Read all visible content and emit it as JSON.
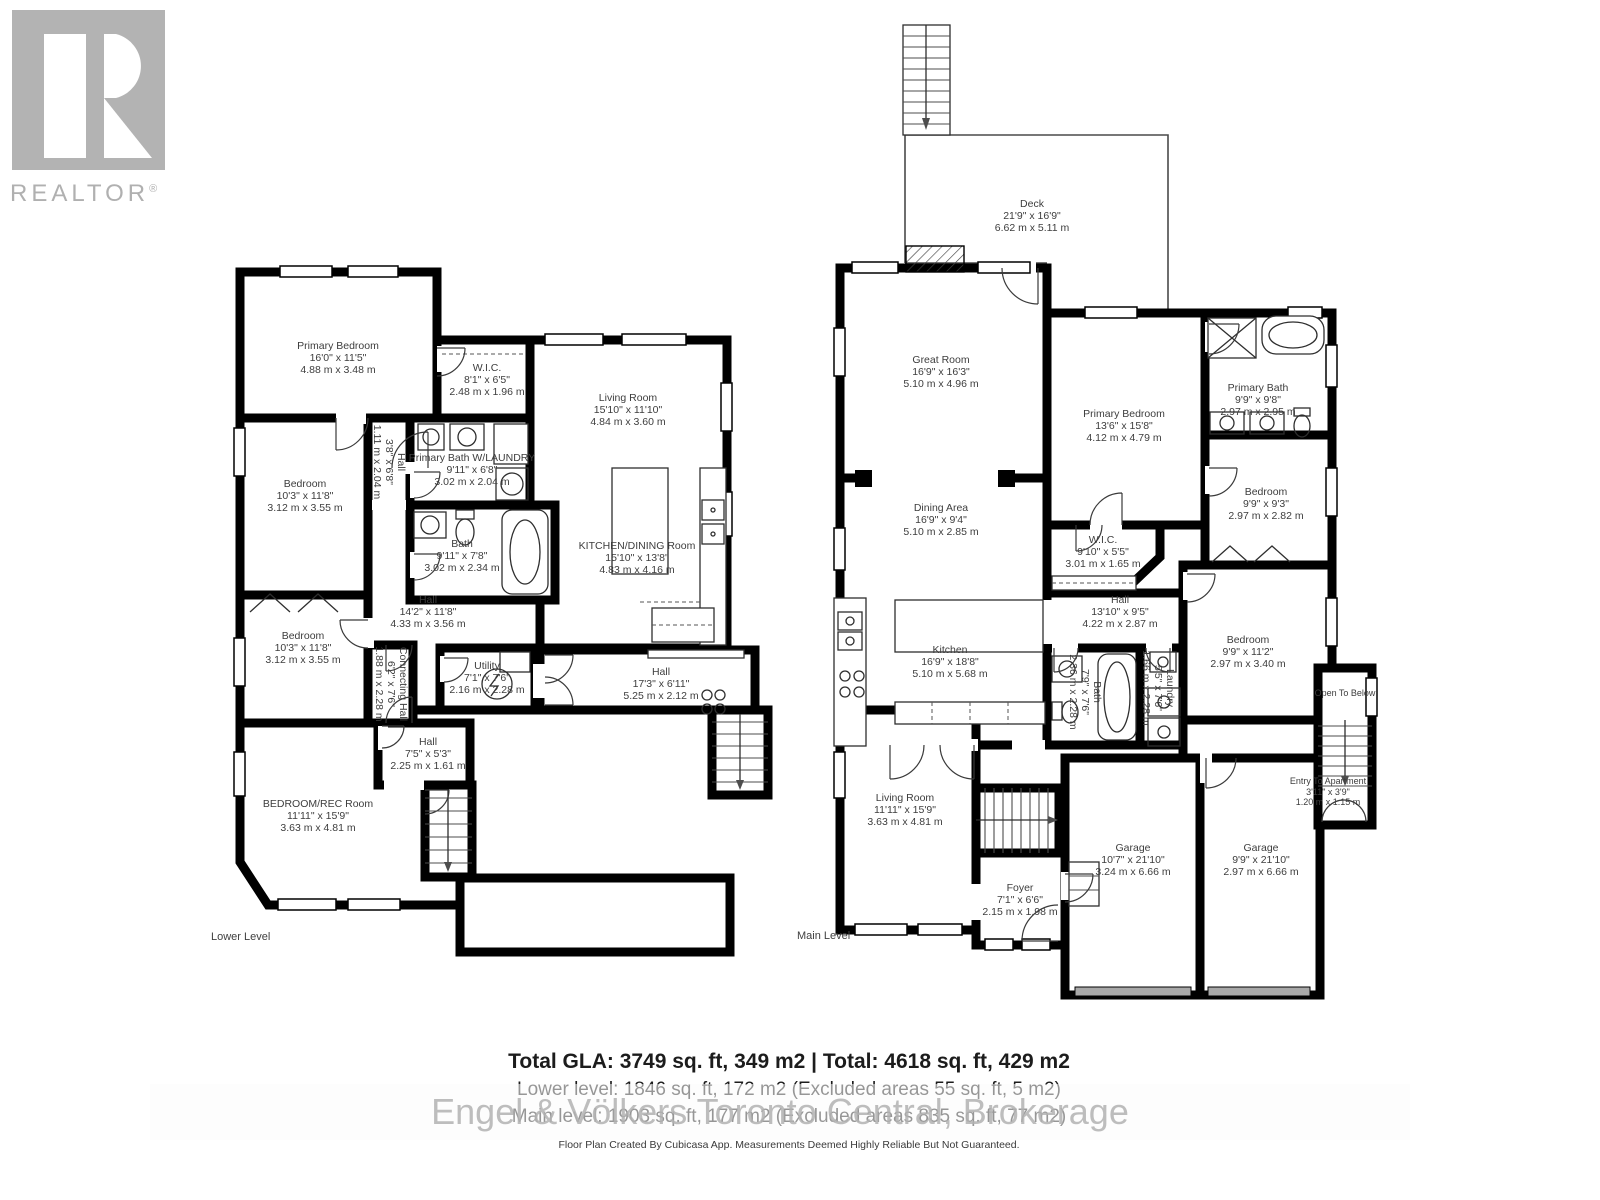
{
  "branding": {
    "realtor": "REALTOR",
    "reg": "®"
  },
  "colors": {
    "wall": "#000000",
    "label_text": "#3d3d3d",
    "logo_gray": "#b3b3b3",
    "watermark_gray": "#c9c9c9",
    "garage_door_gray": "#a8a8a8"
  },
  "floors": {
    "lower": {
      "caption": "Lower Level",
      "rooms": [
        {
          "name": "Primary Bedroom",
          "ft": "16'0\" x 11'5\"",
          "m": "4.88 m x 3.48 m"
        },
        {
          "name": "W.I.C.",
          "ft": "8'1\" x 6'5\"",
          "m": "2.48 m x 1.96 m"
        },
        {
          "name": "Living Room",
          "ft": "15'10\" x 11'10\"",
          "m": "4.84 m x 3.60 m"
        },
        {
          "name": "Bedroom",
          "ft": "10'3\" x 11'8\"",
          "m": "3.12 m x 3.55 m"
        },
        {
          "name": "Hall",
          "ft": "3'8\" x 6'8\"",
          "m": "1.11 m x 2.04 m"
        },
        {
          "name": "Primary Bath W/LAUNDRY",
          "ft": "9'11\" x 6'8\"",
          "m": "3.02 m x 2.04 m"
        },
        {
          "name": "Bath",
          "ft": "9'11\" x 7'8\"",
          "m": "3.02 m x 2.34 m"
        },
        {
          "name": "KITCHEN/DINING Room",
          "ft": "15'10\" x 13'8\"",
          "m": "4.83 m x 4.16 m"
        },
        {
          "name": "Hall",
          "ft": "14'2\" x 11'8\"",
          "m": "4.33 m x 3.56 m"
        },
        {
          "name": "Bedroom",
          "ft": "10'3\" x 11'8\"",
          "m": "3.12 m x 3.55 m"
        },
        {
          "name": "Connecting Hall",
          "ft": "6'2\" x 7'6\"",
          "m": "1.88 m x 2.28 m"
        },
        {
          "name": "Utility",
          "ft": "7'1\" x 7'6\"",
          "m": "2.16 m x 2.28 m"
        },
        {
          "name": "Hall",
          "ft": "17'3\" x 6'11\"",
          "m": "5.25 m x 2.12 m"
        },
        {
          "name": "Hall",
          "ft": "7'5\" x 5'3\"",
          "m": "2.25 m x 1.61 m"
        },
        {
          "name": "BEDROOM/REC Room",
          "ft": "11'11\" x 15'9\"",
          "m": "3.63 m x 4.81 m"
        }
      ]
    },
    "main": {
      "caption": "Main Level",
      "rooms": [
        {
          "name": "Deck",
          "ft": "21'9\" x 16'9\"",
          "m": "6.62 m x 5.11 m"
        },
        {
          "name": "Great Room",
          "ft": "16'9\" x 16'3\"",
          "m": "5.10 m x 4.96 m"
        },
        {
          "name": "Primary Bedroom",
          "ft": "13'6\" x 15'8\"",
          "m": "4.12 m x 4.79 m"
        },
        {
          "name": "Primary Bath",
          "ft": "9'9\" x 9'8\"",
          "m": "2.97 m x 2.95 m"
        },
        {
          "name": "Bedroom",
          "ft": "9'9\" x 9'3\"",
          "m": "2.97 m x 2.82 m"
        },
        {
          "name": "Dining Area",
          "ft": "16'9\" x 9'4\"",
          "m": "5.10 m x 2.85 m"
        },
        {
          "name": "W.I.C.",
          "ft": "9'10\" x 5'5\"",
          "m": "3.01 m x 1.65 m"
        },
        {
          "name": "Hall",
          "ft": "13'10\" x 9'5\"",
          "m": "4.22 m x 2.87 m"
        },
        {
          "name": "Bath",
          "ft": "7'9\" x 7'6\"",
          "m": "2.36 m x 2.28 m"
        },
        {
          "name": "Laundry",
          "ft": "5'5\" x 7'6\"",
          "m": "1.66 m x 2.28 m"
        },
        {
          "name": "Bedroom",
          "ft": "9'9\" x 11'2\"",
          "m": "2.97 m x 3.40 m"
        },
        {
          "name": "Kitchen",
          "ft": "16'9\" x 18'8\"",
          "m": "5.10 m x 5.68 m"
        },
        {
          "name": "Living Room",
          "ft": "11'11\" x 15'9\"",
          "m": "3.63 m x 4.81 m"
        },
        {
          "name": "Open To Below"
        },
        {
          "name": "Entry To Apartment",
          "ft": "3'11\" x 3'9\"",
          "m": "1.20 m x 1.15 m"
        },
        {
          "name": "Foyer",
          "ft": "7'1\" x 6'6\"",
          "m": "2.15 m x 1.98 m"
        },
        {
          "name": "Garage",
          "ft": "10'7\" x 21'10\"",
          "m": "3.24 m x 6.66 m"
        },
        {
          "name": "Garage",
          "ft": "9'9\" x 21'10\"",
          "m": "2.97 m x 6.66 m"
        }
      ]
    }
  },
  "summary": {
    "total": "Total GLA: 3749 sq. ft, 349 m2 | Total: 4618 sq. ft, 429 m2",
    "lower": "Lower level: 1846 sq. ft, 172 m2 (Excluded areas 55 sq. ft, 5 m2)",
    "main": "Main level: 1903 sq. ft, 177 m2 (Excluded areas 835 sq. ft, 77 m2)",
    "watermark": "Engel & Völkers Toronto Central, Brokerage",
    "disclaimer": "Floor Plan Created By Cubicasa App. Measurements Deemed Highly Reliable But Not Guaranteed."
  }
}
